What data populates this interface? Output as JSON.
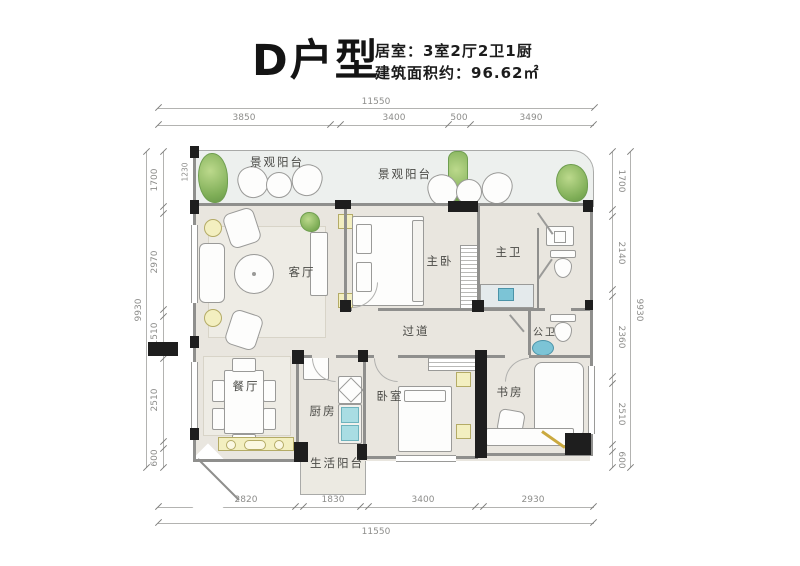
{
  "header": {
    "title": "D户型",
    "info_line_1": "居室：3室2厅2卫1厨",
    "info_line_2": "建筑面积约：96.62㎡"
  },
  "rooms": {
    "balcony_left": "景观阳台",
    "balcony_right": "景观阳台",
    "living": "客厅",
    "master_bedroom": "主卧",
    "master_bath": "主卫",
    "corridor": "过道",
    "public_bath": "公卫",
    "dining": "餐厅",
    "kitchen": "厨房",
    "bedroom": "卧室",
    "study": "书房",
    "service_balcony": "生活阳台"
  },
  "dimensions": {
    "top": {
      "total": "11550",
      "segments": [
        "3850",
        "3400",
        "500",
        "3490"
      ]
    },
    "bottom": {
      "total": "11550",
      "segments": [
        "2820",
        "1830",
        "3400",
        "2930"
      ]
    },
    "left": {
      "total": "9930",
      "segments": [
        "1700",
        "2970",
        "1510",
        "2510",
        "600"
      ]
    },
    "right": {
      "total": "9930",
      "segments": [
        "1700",
        "2140",
        "2360",
        "2510",
        "600"
      ]
    },
    "balcony_inner": "1230"
  },
  "colors": {
    "floor": "#e9e6df",
    "balcony_floor": "#edf0ee",
    "wall": "#1e1e1e",
    "plant_green": "#7fae57",
    "accent_yellow": "#f3efc0",
    "accent_blue": "#7cc4d6"
  }
}
